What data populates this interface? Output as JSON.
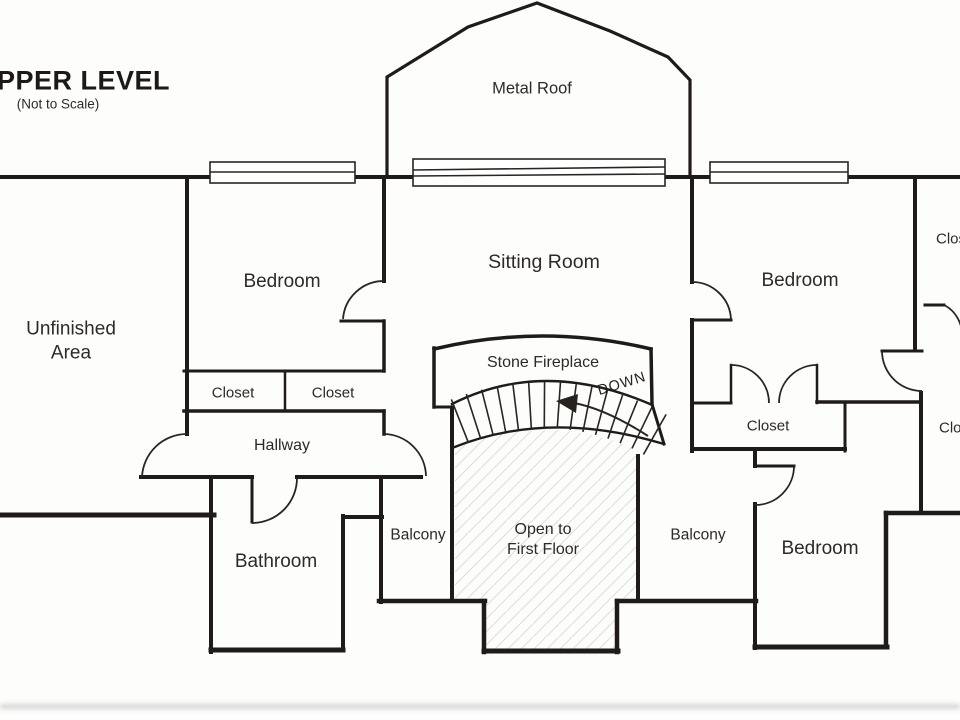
{
  "title": {
    "text": "PPER LEVEL",
    "subtitle": "(Not to Scale)"
  },
  "labels": {
    "metal_roof": "Metal Roof",
    "unfinished_area": "Unfinished\nArea",
    "bedroom_left": "Bedroom",
    "sitting_room": "Sitting Room",
    "bedroom_right": "Bedroom",
    "closet_hall_left": "Closet",
    "closet_hall_right": "Closet",
    "hallway": "Hallway",
    "bathroom": "Bathroom",
    "stone_fireplace": "Stone Fireplace",
    "down": "DOWN",
    "balcony_left": "Balcony",
    "balcony_right": "Balcony",
    "open_to_first_floor": "Open to\nFirst Floor",
    "closet_mid_right": "Closet",
    "bedroom_bottom_right": "Bedroom",
    "closet_top_right_edge": "Closet",
    "closet_mid_right_edge": "Closet"
  },
  "stairs": {
    "treads": 15
  }
}
